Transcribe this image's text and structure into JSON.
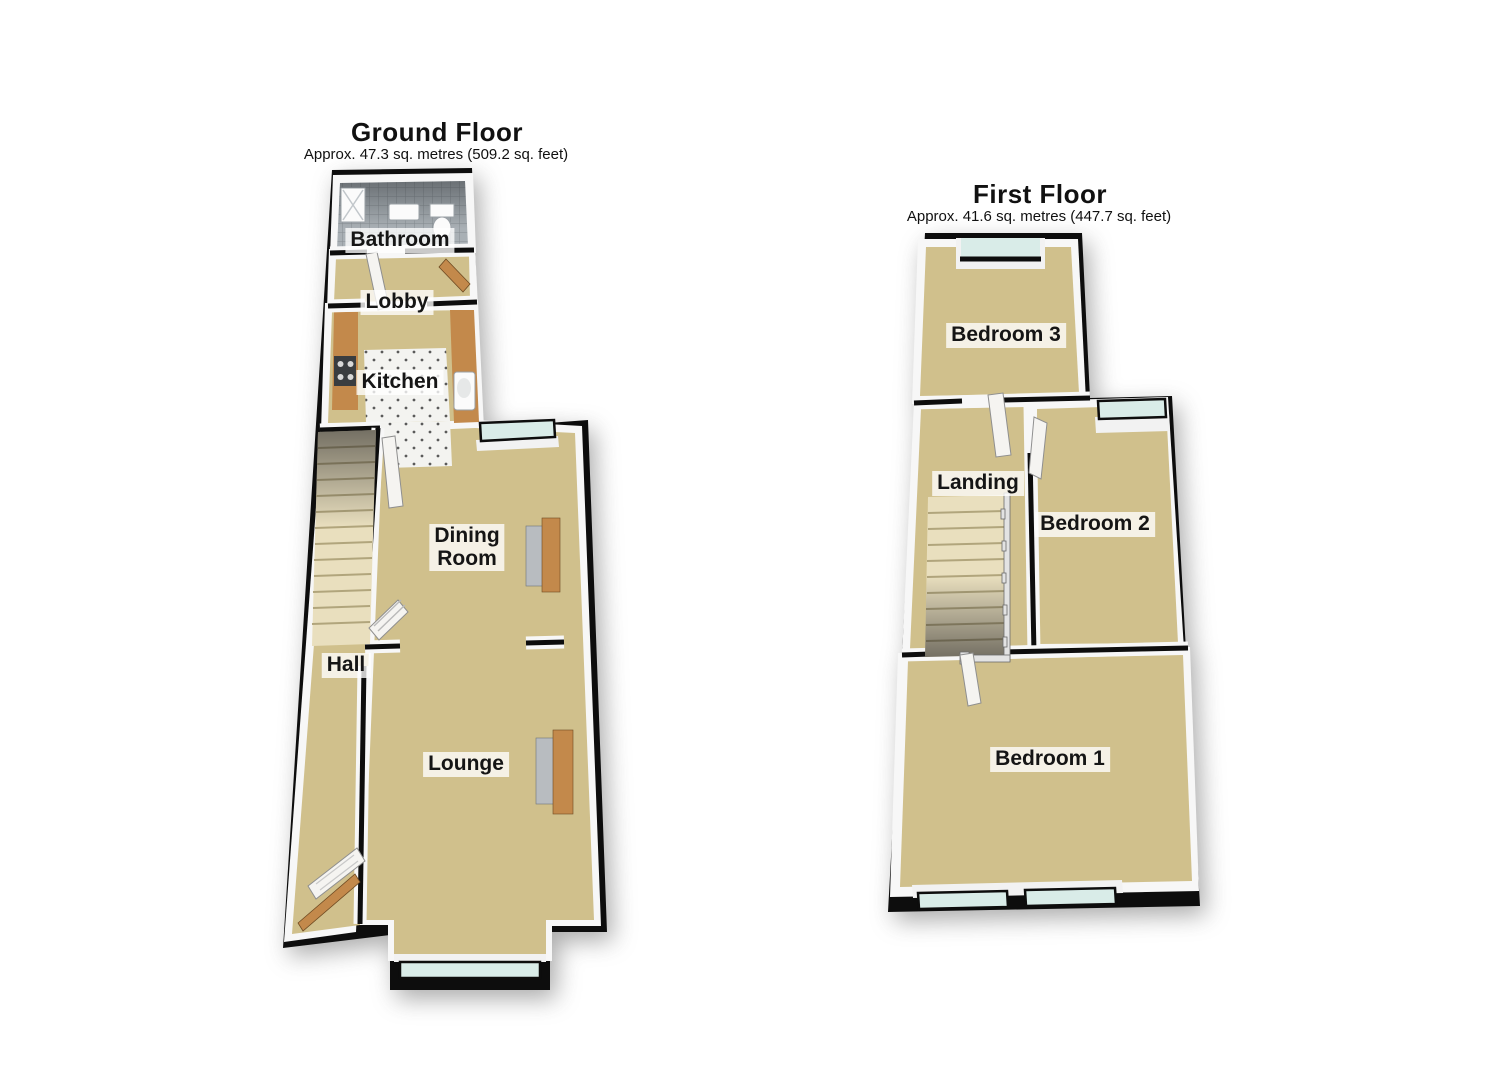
{
  "floors": [
    {
      "id": "ground",
      "title": "Ground Floor",
      "subtitle": "Approx. 47.3 sq. metres (509.2 sq. feet)",
      "rooms": [
        {
          "label": "Bathroom"
        },
        {
          "label": "Lobby"
        },
        {
          "label": "Kitchen"
        },
        {
          "label": "Dining Room",
          "lines": [
            "Dining",
            "Room"
          ]
        },
        {
          "label": "Hall"
        },
        {
          "label": "Lounge"
        }
      ]
    },
    {
      "id": "first",
      "title": "First Floor",
      "subtitle": "Approx. 41.6 sq. metres (447.7 sq. feet)",
      "rooms": [
        {
          "label": "Bedroom 3"
        },
        {
          "label": "Landing"
        },
        {
          "label": "Bedroom 2"
        },
        {
          "label": "Bedroom 1"
        }
      ]
    }
  ],
  "colors": {
    "wall": "#0d0d0d",
    "wall_face": "#f7f7f7",
    "carpet": "#d0c08c",
    "bathroom_tile": "#a9b0b5",
    "kitchen_tile": "#f3f3f0",
    "window_glass": "#d9ece8",
    "wood": "#c3894b",
    "stairs": "#e9dfbe",
    "hearth": "#b8bcc0"
  }
}
